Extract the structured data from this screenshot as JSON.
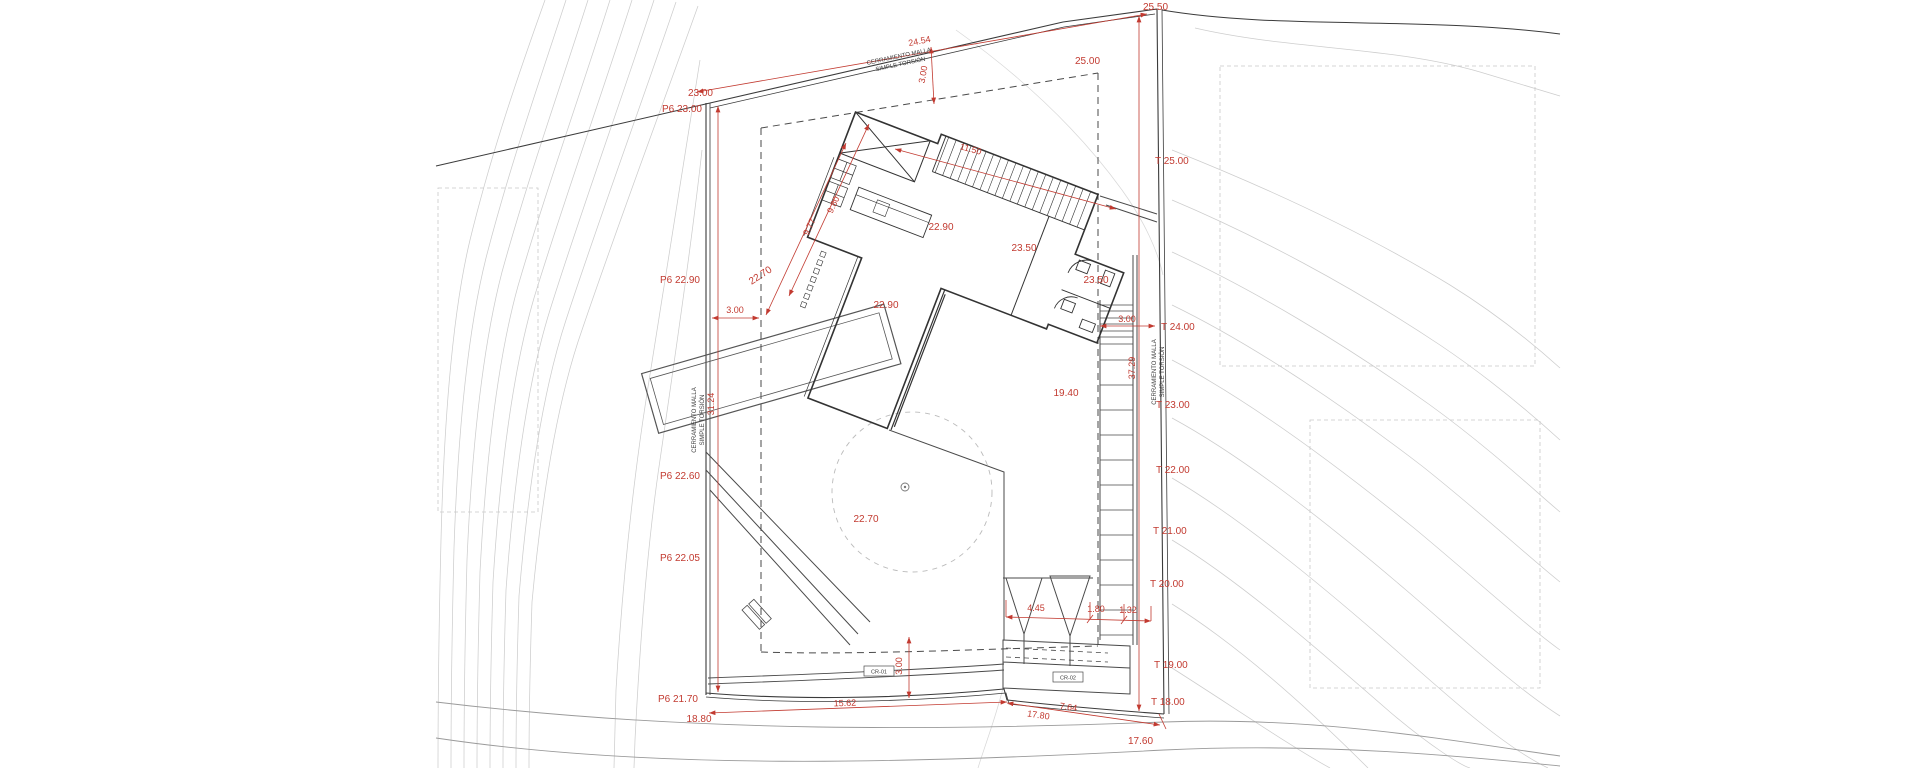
{
  "plan": {
    "type": "architectural site plan",
    "colors": {
      "red": "#c23a30",
      "line": "#3a3a3a",
      "contour": "#cccccc"
    },
    "fence": {
      "line1": "CERRAMIENTO MALLA",
      "line2": "SIMPLE TORSIÓN"
    },
    "corner_levels": {
      "top_left": "23.00",
      "top_right": "25.50",
      "setback_platform": "25.00",
      "bottom_left": "18.80",
      "bottom_right": "17.60"
    },
    "perimeter_left": [
      {
        "label": "P6 23.00"
      },
      {
        "label": "P6 22.90"
      },
      {
        "label": "P6 22.60"
      },
      {
        "label": "P6 22.05"
      },
      {
        "label": "P6 21.70"
      }
    ],
    "terrain_right": [
      {
        "label": "T 25.00"
      },
      {
        "label": "T 24.00"
      },
      {
        "label": "T 23.00"
      },
      {
        "label": "T 22.00"
      },
      {
        "label": "T 21.00"
      },
      {
        "label": "T 20.00"
      },
      {
        "label": "T 19.00"
      },
      {
        "label": "T 18.00"
      }
    ],
    "floor_levels": {
      "living_a": "22.90",
      "living_b": "22.90",
      "upper_a": "23.50",
      "upper_b": "23.50",
      "stair_landing": "19.40",
      "terrace_circle": "22.70",
      "path_level": "22.70"
    },
    "dimensions": {
      "top_boundary": "24.54",
      "setback_top": "3.00",
      "setback_left": "3.00",
      "setback_right": "3.00",
      "setback_bottom": "3.00",
      "left_boundary": "31.24",
      "right_boundary": "37.29",
      "stair_edge": "11.50",
      "house_side_a": "9.80",
      "house_side_b": "9.77",
      "court_a": "4.45",
      "court_b": "1.80",
      "court_c": "1.32",
      "bottom_a": "15.62",
      "bottom_b": "17.80",
      "bottom_c": "7.64"
    },
    "ref_boxes": {
      "cr01": "CR-01",
      "cr02": "CR-02"
    }
  }
}
